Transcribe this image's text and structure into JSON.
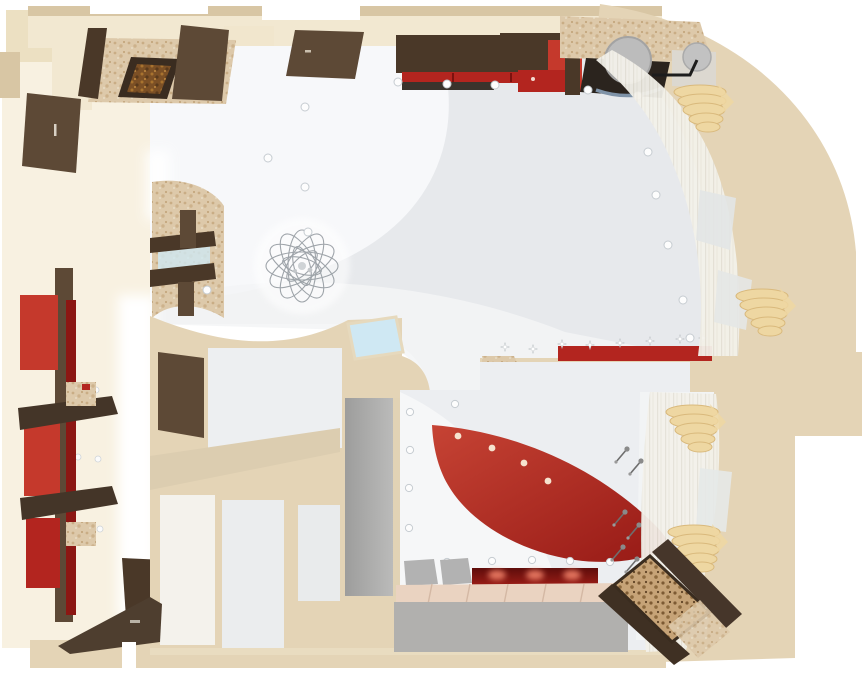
{
  "scene": {
    "type": "apartment-interior-top-view-3d-render",
    "rooms": [
      {
        "name": "living-room",
        "position": "top-left-and-center"
      },
      {
        "name": "study-corner",
        "position": "top-right"
      },
      {
        "name": "hallway-and-bathrooms",
        "position": "center-left"
      },
      {
        "name": "bedroom",
        "position": "bottom-right"
      }
    ],
    "objects": [
      "fireplace-stone-wall",
      "entry-door",
      "interior-door",
      "wall-wardrobe",
      "red-sideboard",
      "desk-with-monitor",
      "office-chair",
      "side-chair",
      "curved-window-wall",
      "sheer-curtains",
      "gold-drape-swags",
      "chandelier",
      "recessed-spotlights",
      "tv-shelf-unit",
      "red-shelving-wall",
      "cove-light-strip",
      "skylight",
      "gray-wardrobe",
      "red-ceiling-sail",
      "red-light-shelves",
      "red-floor-cove",
      "poufs",
      "tiled-floor-strip",
      "bed-with-ornate-headboard",
      "pendant-lamps",
      "open-door-bottom-left"
    ]
  },
  "colors": {
    "page_bg": "#ffffff",
    "wall_beige": "#e4d4b6",
    "wall_beige_dark": "#d8c6a4",
    "wall_cream": "#f2e8d1",
    "wall_cream_pale": "#f8f1e1",
    "ceiling_gray": "#e7e9ec",
    "ceiling_white": "#f8f9fb",
    "accent_red": "#b3251f",
    "accent_red_bright": "#c5392c",
    "accent_red_dark": "#8c1713",
    "wood_dark": "#4a3828",
    "wood_mid": "#5d4936",
    "stone_beige": "#dcc9ab",
    "curtain_gold": "#eed7a2",
    "sheer_white": "#f3f1ea",
    "glass_blue": "#cfe8f3",
    "furniture_gray": "#b2b2b2",
    "tile_pink": "#ead3c1",
    "glow_white": "#ffffff"
  }
}
